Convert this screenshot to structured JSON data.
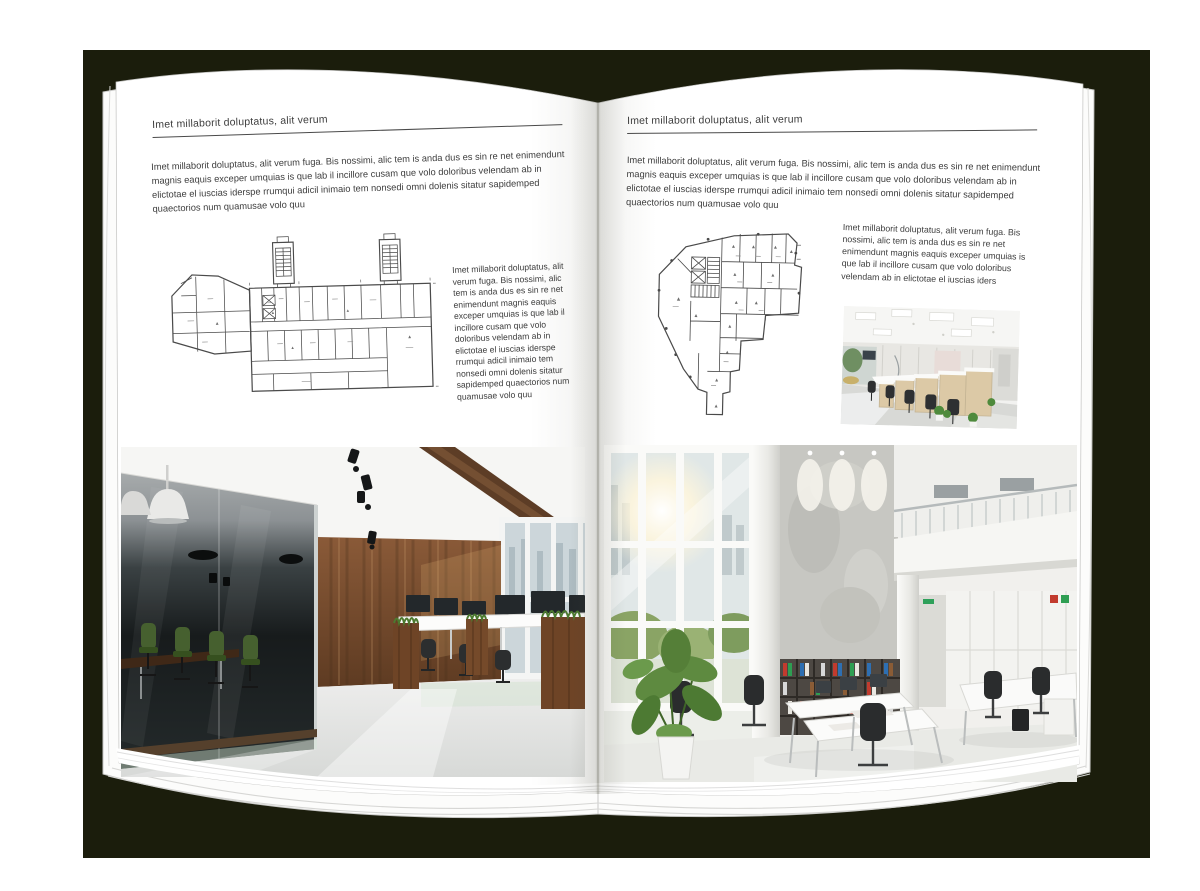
{
  "palette": {
    "backdrop": "#1b1d0c",
    "page": "#ffffff",
    "text": "#3d3d3d",
    "rule": "#4a4a4a",
    "plan_lines": "#4a4a4a",
    "wood_wall": "#7a4e2e",
    "glass_dark": "#1a1f20",
    "chair_green": "#46602f",
    "plant_green": "#55833a",
    "floor_gray": "#e2e3e1"
  },
  "left_page": {
    "header": "Imet millaborit doluptatus, alit verum",
    "intro": "Imet millaborit doluptatus, alit verum fuga. Bis nossimi, alic tem is anda dus es sin re net enimendunt magnis eaquis exceper umquias is que lab il incillore cusam que volo doloribus velendam ab in elictotae el iuscias iderspe rrumqui adicil inimaio tem nonsedi omni dolenis sitatur sapidemped quaectorios num quamusae volo quu",
    "caption": "Imet millaborit doluptatus, alit verum fuga. Bis nossimi, alic tem is anda dus es sin re net enimendunt magnis eaquis exceper umquias is que lab il incillore cusam que volo doloribus velendam ab in elictotae el iuscias iderspe rrumqui adicil inimaio tem nonsedi omni dolenis sitatur sapidemped quaectorios num quamusae volo quu"
  },
  "right_page": {
    "header": "Imet millaborit doluptatus, alit verum",
    "intro": "Imet millaborit doluptatus, alit verum fuga. Bis nossimi, alic tem is anda dus es sin re net enimendunt magnis eaquis exceper umquias is que lab il incillore cusam que volo doloribus velendam ab in elictotae el iuscias iderspe rrumqui adicil inimaio tem nonsedi omni dolenis sitatur sapidemped quaectorios num quamusae volo quu",
    "caption": "Imet millaborit doluptatus, alit verum fuga. Bis nossimi, alic tem is anda dus es sin re net enimendunt magnis eaquis exceper umquias is que lab il incillore cusam que volo doloribus velendam ab in elictotae el iuscias iders"
  }
}
